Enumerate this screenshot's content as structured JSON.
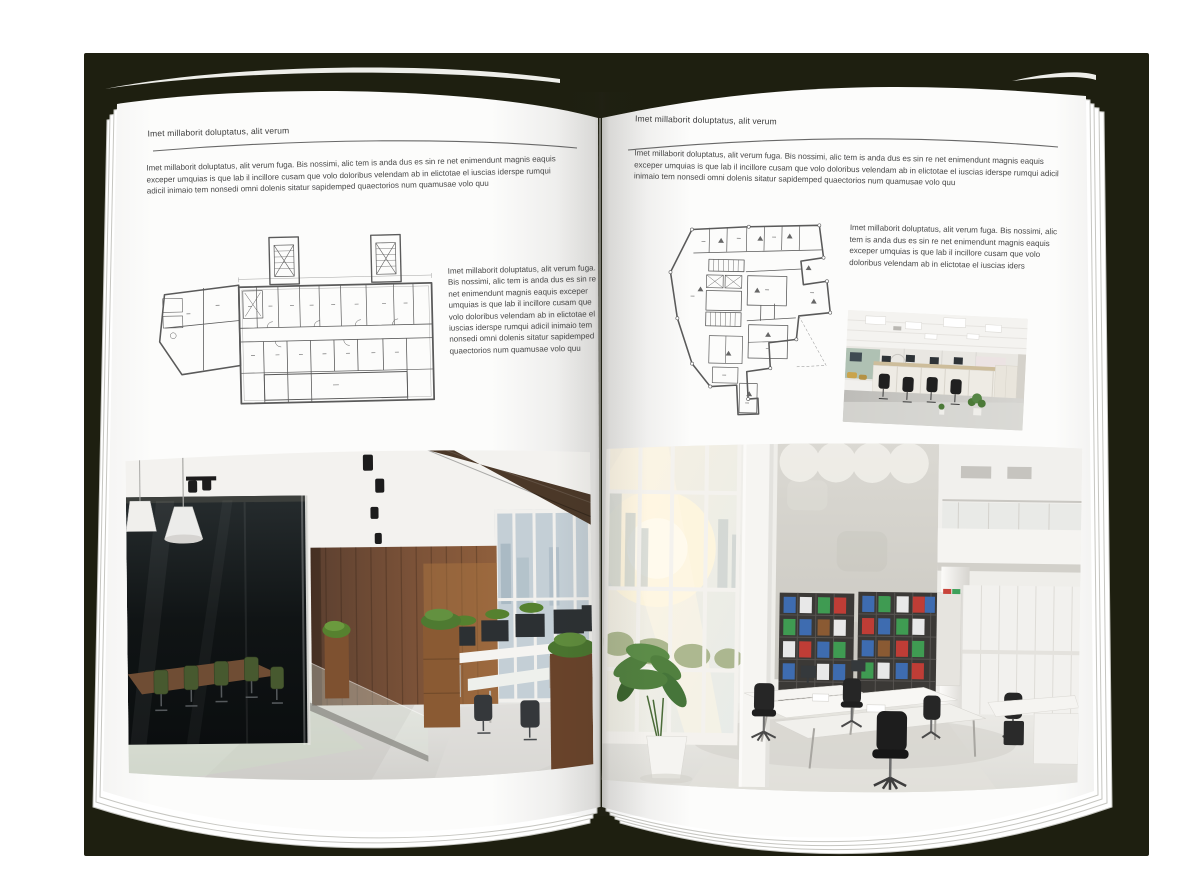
{
  "colors": {
    "backdrop": "#1e1f10",
    "paper": "#fcfcfb",
    "text": "#474747",
    "rule": "#686868",
    "plan_line": "#5a5a5a"
  },
  "left_page": {
    "header": "Imet millaborit doluptatus, alit verum",
    "intro": "Imet millaborit doluptatus, alit verum fuga. Bis nossimi, alic tem is anda dus es sin re net enimendunt magnis eaquis exceper umquias is que lab il incillore cusam que volo doloribus velendam ab in elictotae el iuscias iderspe rumqui adicil inimaio tem nonsedi omni dolenis sitatur sapidemped quaectorios num quamusae volo quu",
    "caption": "Imet millaborit doluptatus, alit verum fuga. Bis nossimi, alic tem is anda dus es sin re net enimendunt magnis eaquis exceper umquias is que lab il incillore cusam que volo doloribus velendam ab in elictotae el iuscias iderspe rumqui adicil inimaio tem nonsedi omni dolenis sitatur sapidemped quaectorios num quamusae volo quu"
  },
  "right_page": {
    "header": "Imet millaborit doluptatus, alit verum",
    "intro": "Imet millaborit doluptatus, alit verum fuga. Bis nossimi, alic tem is anda dus es sin re net enimendunt magnis eaquis exceper umquias is que lab il incillore cusam que volo doloribus velendam ab in elictotae el iuscias iderspe rumqui adicil inimaio tem nonsedi omni dolenis sitatur sapidemped quaectorios num quamusae volo quu",
    "caption": "Imet millaborit doluptatus, alit verum fuga. Bis nossimi, alic tem is anda dus es sin re net enimendunt magnis eaquis exceper umquias is que lab il incillore cusam que volo doloribus velendam ab in elictotae el iuscias iders"
  }
}
